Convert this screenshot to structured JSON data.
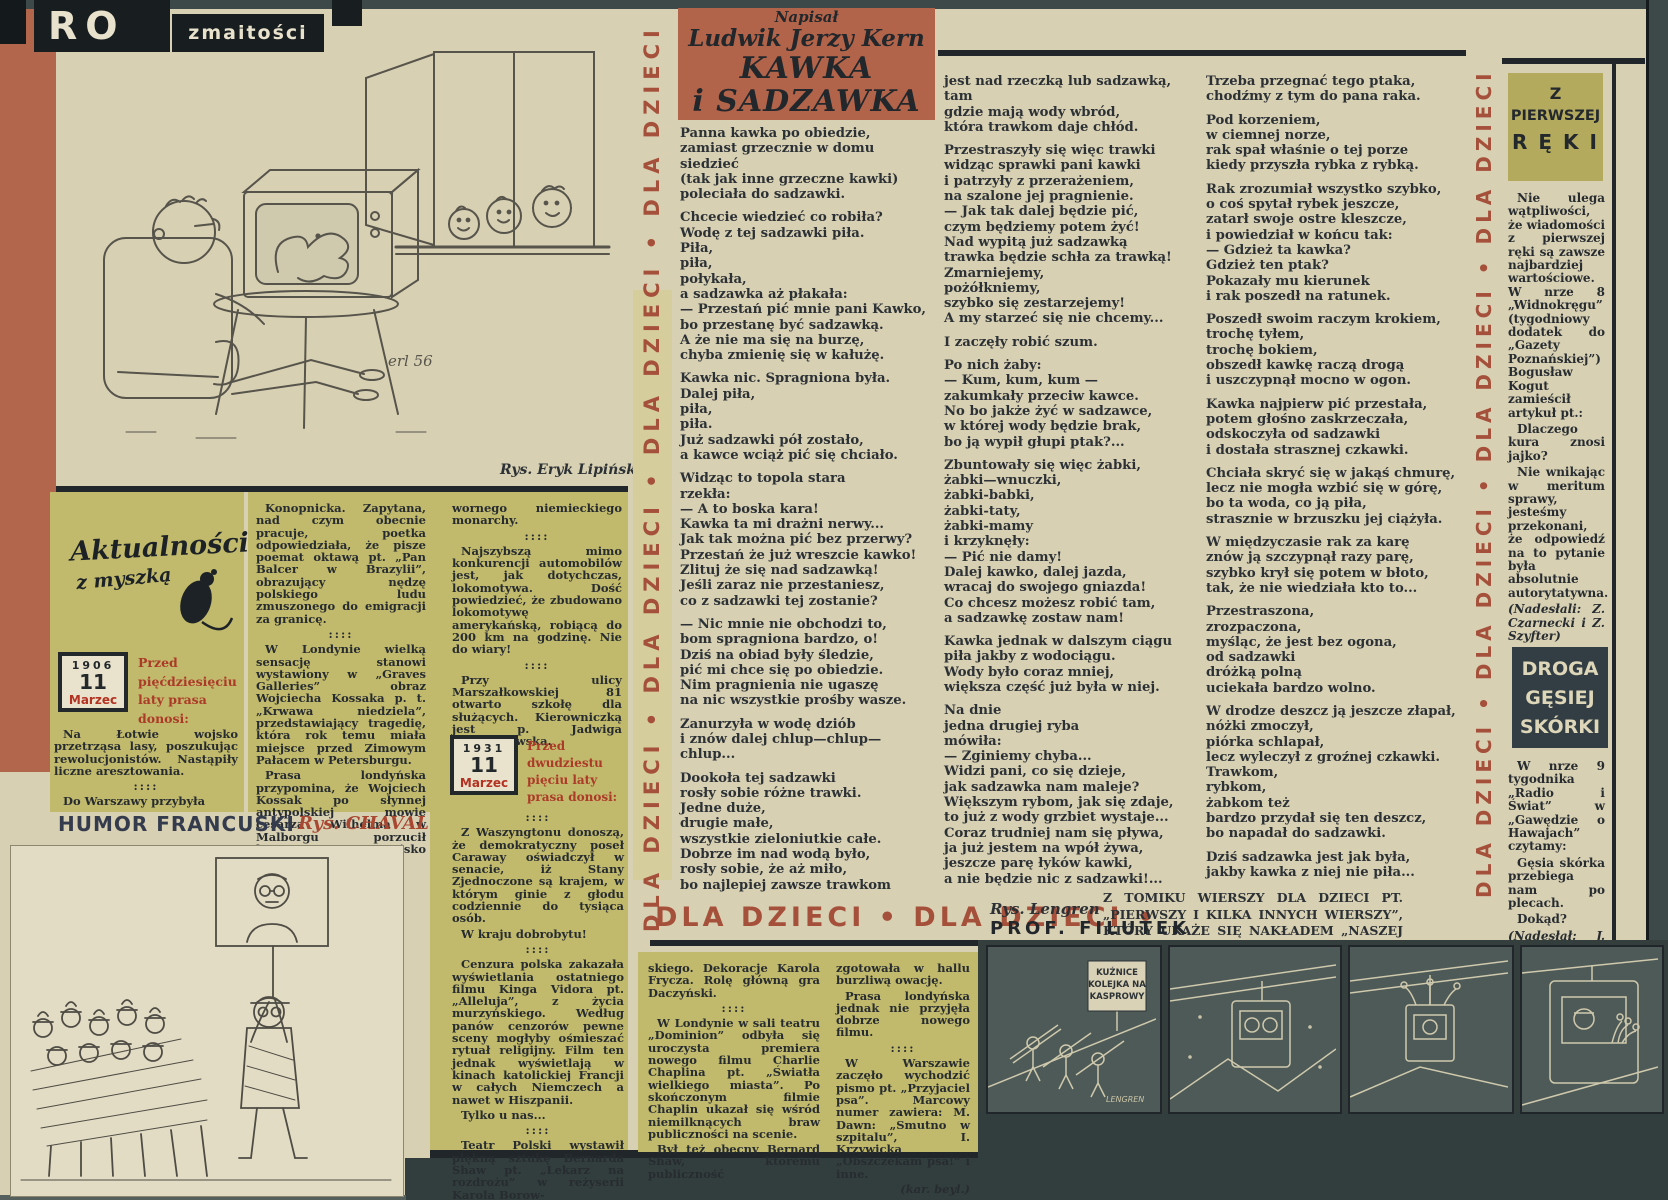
{
  "masthead": {
    "part1": "RO",
    "part2": "zmaitości"
  },
  "strips": {
    "left": "DLA DZIECI • DLA DZIECI • DLA DZIECI • DLA DZIECI",
    "right": "DLA DZIECI • DLA DZIECI • DLA DZIECI • DLA DZIECI",
    "bottom": "DLA DZIECI  •  DLA DZIECI  •"
  },
  "poem": {
    "written_by": "Napisał",
    "author": "Ludwik Jerzy Kern",
    "title_line1": "KAWKA",
    "title_line2": "i SADZAWKA",
    "illustration_credit": "Rys. Eryk Lipiński",
    "illustration_signature": "erl 56",
    "col1": [
      [
        "Panna kawka po obiedzie,",
        "zamiast grzecznie w domu siedzieć",
        "(tak jak inne grzeczne kawki)",
        "poleciała do sadzawki."
      ],
      [
        "Chcecie wiedzieć co robiła?",
        "Wodę z tej sadzawki piła.",
        "Piła,",
        "piła,",
        "połykała,",
        "a sadzawka aż płakała:",
        "— Przestań pić mnie pani Kawko,",
        "bo przestanę być sadzawką.",
        "A że nie ma się na burzę,",
        "chyba zmienię się w kałużę."
      ],
      [
        "Kawka nic. Spragniona była.",
        "Dalej piła,",
        "piła,",
        "piła.",
        "Już sadzawki pół zostało,",
        "a kawce wciąż pić się chciało."
      ],
      [
        "Widząc to topola stara",
        "rzekła:",
        "— A to boska kara!",
        "Kawka ta mi drażni nerwy...",
        "Jak tak można pić bez przerwy?",
        "Przestań że już wreszcie kawko!",
        "Zlituj że się nad sadzawką!",
        "Jeśli zaraz nie przestaniesz,",
        "co z sadzawki tej zostanie?"
      ],
      [
        "— Nic mnie nie obchodzi to,",
        "bom spragniona bardzo, o!",
        "Dziś na obiad były śledzie,",
        "pić mi chce się po obiedzie.",
        "Nim pragnienia nie ugaszę",
        "na nic wszystkie prośby wasze."
      ],
      [
        "Zanurzyła w wodę dziób",
        "i znów dalej chlup—chlup—chlup..."
      ],
      [
        "Dookoła tej sadzawki",
        "rosły sobie różne trawki.",
        "Jedne duże,",
        "drugie małe,",
        "wszystkie zieloniutkie całe.",
        "Dobrze im nad wodą było,",
        "rosły sobie, że aż miło,",
        "bo najlepiej zawsze trawkom"
      ]
    ],
    "col2": [
      [
        "jest nad rzeczką lub sadzawką,",
        "tam",
        "gdzie mają wody wbród,",
        "która trawkom daje chłód."
      ],
      [
        "Przestraszyły się więc trawki",
        "widząc sprawki pani kawki",
        "i patrzyły z przerażeniem,",
        "na szalone jej pragnienie.",
        "— Jak tak dalej będzie pić,",
        "czym będziemy potem żyć!",
        "Nad wypitą już sadzawką",
        "trawka będzie schła za trawką!",
        "Zmarniejemy,",
        "pożółkniemy,",
        "szybko się zestarzejemy!",
        "A my starzeć się nie chcemy..."
      ],
      [
        "I zaczęły robić szum."
      ],
      [
        "Po nich żaby:",
        "— Kum, kum, kum —",
        "zakumkały przeciw kawce.",
        "No bo jakże żyć w sadzawce,",
        "w której wody będzie brak,",
        "bo ją wypił głupi ptak?..."
      ],
      [
        "Zbuntowały się więc żabki,",
        "żabki—wnuczki,",
        "żabki-babki,",
        "żabki-taty,",
        "żabki-mamy",
        "i krzyknęły:",
        "— Pić nie damy!",
        "Dalej kawko, dalej jazda,",
        "wracaj do swojego gniazda!",
        "Co chcesz możesz robić tam,",
        "a sadzawkę zostaw nam!"
      ],
      [
        "Kawka jednak w dalszym ciągu",
        "piła jakby z wodociągu.",
        "Wody było coraz mniej,",
        "większa część już była w niej."
      ],
      [
        "Na dnie",
        "jedna drugiej ryba",
        "mówiła:",
        "— Zginiemy chyba...",
        "Widzi pani, co się dzieje,",
        "jak sadzawka nam maleje?",
        "Większym rybom, jak się zdaje,",
        "to już z wody grzbiet wystaje...",
        "Coraz trudniej nam się pływa,",
        "ja już jestem na wpół żywa,",
        "jeszcze parę łyków kawki,",
        "a nie będzie nic z sadzawki!..."
      ]
    ],
    "col3": [
      [
        "Trzeba przegnać tego ptaka,",
        "chodźmy z tym do pana raka."
      ],
      [
        "Pod korzeniem,",
        "w ciemnej norze,",
        "rak spał właśnie o tej porze",
        "kiedy przyszła rybka z rybką."
      ],
      [
        "Rak zrozumiał wszystko szybko,",
        "o coś spytał rybek jeszcze,",
        "zatarł swoje ostre kleszcze,",
        "i powiedział w końcu tak:",
        "— Gdzież ta kawka?",
        "Gdzież ten ptak?",
        "Pokazały mu kierunek",
        "i rak poszedł na ratunek."
      ],
      [
        "Poszedł swoim raczym krokiem,",
        "trochę tyłem,",
        "trochę bokiem,",
        "obszedł kawkę raczą drogą",
        "i uszczypnął mocno w ogon."
      ],
      [
        "Kawka najpierw pić przestała,",
        "potem głośno zaskrzeczała,",
        "odskoczyła od sadzawki",
        "i dostała strasznej czkawki."
      ],
      [
        "Chciała skryć się w jakąś chmurę,",
        "lecz nie mogła wzbić się w górę,",
        "bo ta woda, co ją piła,",
        "strasznie w brzuszku jej ciążyła."
      ],
      [
        "W międzyczasie rak za karę",
        "znów ją szczypnął razy parę,",
        "szybko krył się potem w błoto,",
        "tak, że nie wiedziała kto to..."
      ],
      [
        "Przestraszona,",
        "zrozpaczona,",
        "myśląc, że jest bez ogona,",
        "od sadzawki",
        "dróżką polną",
        "uciekała bardzo wolno."
      ],
      [
        "W drodze deszcz ją jeszcze złapał,",
        "nóżki zmoczył,",
        "piórka schlapał,",
        "lecz wyleczył z groźnej czkawki.",
        "Trawkom,",
        "rybkom,",
        "żabkom też",
        "bardzo przydał się ten deszcz,",
        "bo napadał do sadzawki."
      ],
      [
        "Dziś sadzawka jest jak była,",
        "jakby kawka z niej nie piła..."
      ]
    ],
    "footer_note": "Z TOMIKU WIERSZY DLA DZIECI PT. „PIERWSZY I KILKA INNYCH WIERSZY”, KTÓRY UKAŻE SIĘ NAKŁADEM „NASZEJ KSIĘGARNI”"
  },
  "aktualnosci": {
    "logo_line1": "Aktualności",
    "logo_line2": "z myszką",
    "cal1": {
      "year": "1906",
      "day": "11",
      "month": "Marzec"
    },
    "lead1": "Przed pięćdziesięciu laty prasa donosi:",
    "intro": [
      "Na Łotwie wojsko przetrząsa lasy, poszukując rewolucjonistów. Nastąpiły liczne aresztowania.",
      "::::",
      "Do Warszawy przybyła"
    ],
    "colA": [
      "Konopnicka. Zapytana, nad czym obecnie pracuje, poetka odpowiedziała, że pisze poemat oktawą pt. „Pan Balcer w Brazylii”, obrazujący nędzę polskiego ludu zmuszonego do emigracji za granicę.",
      "::::",
      "W Londynie wielką sensację stanowi wystawiony w „Graves Galleries” obraz Wojciecha Kossaka p. t. „Krwawa niedziela”, przedstawiający tragedię, która rok temu miała miejsce przed Zimowym Pałacem w Petersburgu.",
      "Prasa londyńska przypomina, że Wojciech Kossak po słynnej antypolskiej mowie cesarza Wilhelma w Malborgu porzucił korzystne stanowisko malarza nad-"
    ],
    "colB_top": [
      "wornego niemieckiego monarchy.",
      "::::",
      "Najszybszą mimo konkurencji automobilów jest, jak dotychczas, lokomotywa. Dość powiedzieć, że zbudowano lokomotywę amerykańską, robiącą do 200 km na godzinę. Nie do wiary!",
      "::::",
      "Przy ulicy Marszałkowskiej 81 otwarto szkołę dla służących. Kierowniczką jest p. Jadwiga Chachanowska."
    ],
    "cal2": {
      "year": "1931",
      "day": "11",
      "month": "Marzec"
    },
    "lead2": "Przed dwudziestu pięciu laty prasa donosi:",
    "colB_bottom": [
      "::::",
      "Z Waszyngtonu donoszą, że demokratyczny poseł Caraway oświadczył w senacie, iż Stany Zjednoczone są krajem, w którym ginie z głodu codziennie do tysiąca osób.",
      "W kraju dobrobytu!",
      "::::",
      "Cenzura polska zakazała wyświetlania ostatniego filmu Kinga Vidora pt. „Alleluja”, z życia murzyńskiego. Według panów cenzorów pewne sceny mogłyby ośmieszać rytuał religijny. Film ten jednak wyświetlają w kinach katolickiej Francji w całych Niemczech a nawet w Hiszpanii.",
      "Tylko u nas...",
      "::::",
      "Teatr Polski wystawił piękną sztukę Bernarda Shaw pt. „Lekarz na rozdrożu” w reżyserii Karola Borow-"
    ],
    "colC": [
      "skiego. Dekoracje Karola Frycza. Rolę główną gra Daczyński.",
      "::::",
      "W Londynie w sali teatru „Dominion” odbyła się uroczysta premiera nowego filmu Charlie Chaplina pt. „Światła wielkiego miasta”. Po skończonym filmie Chaplin ukazał się wśród niemilknących braw publiczności na scenie.",
      "Był też obecny Bernard Shaw, któremu publiczność"
    ],
    "colD": [
      "zgotowała w hallu burzliwą owację.",
      "Prasa londyńska jednak nie przyjęła dobrze nowego filmu.",
      "::::",
      "W Warszawie zaczęło wychodzić pismo pt. „Przyjaciel psa”. Marcowy numer zawiera: M. Dawn: „Smutno w szpitalu”, I. Krzywicka „Obszczekam psa!” i inne.",
      "(kar. beyl.)"
    ]
  },
  "humor": {
    "title": "HUMOR FRANCUSKI",
    "credit": "Rys. CHAVAL"
  },
  "filutek": {
    "credit": "Rys. Lengren",
    "title": "PROF. FILUTEK",
    "sign_l1": "KUŹNICE",
    "sign_l2": "KOLEJKA NA",
    "sign_l3": "KASPROWY",
    "signature": "LENGREN"
  },
  "sidebar": {
    "box1_l1": "Z",
    "box1_l2": "PIERWSZEJ",
    "box1_l3": "R Ę K I",
    "paras1": [
      "Nie ulega wątpliwości, że wiadomości z pierwszej ręki są zawsze najbardziej wartościowe. W nrze 8 „Widnokręgu” (tygodniowy dodatek do „Gazety Poznańskiej”) Bogusław Kogut zamieścił artykuł pt.:",
      "Dlaczego kura znosi jajko?",
      "Nie wnikając w meritum sprawy, jesteśmy przekonani, że odpowiedź na to pytanie była absolutnie autorytatywna.",
      "(Nadesłali: Z. Czarnecki i Z. Szyfter)"
    ],
    "box2_l1": "DROGA",
    "box2_l2": "GĘSIEJ",
    "box2_l3": "SKÓRKI",
    "paras2": [
      "W nrze 9 tygodnika „Radio i Świat” w „Gawędzie o Hawajach” czytamy:",
      "Gęsia skórka przebiega nam po plecach.",
      "Dokąd?",
      "(Nadesłał: J. Merchut)"
    ]
  },
  "colors": {
    "paper": "#d8d0b3",
    "olive": "#c1b96b",
    "terracotta": "#b2644a",
    "brick_text": "#a5503a",
    "ink": "#2c3135",
    "frame": "#3c4948",
    "panel": "#4e5a57"
  }
}
